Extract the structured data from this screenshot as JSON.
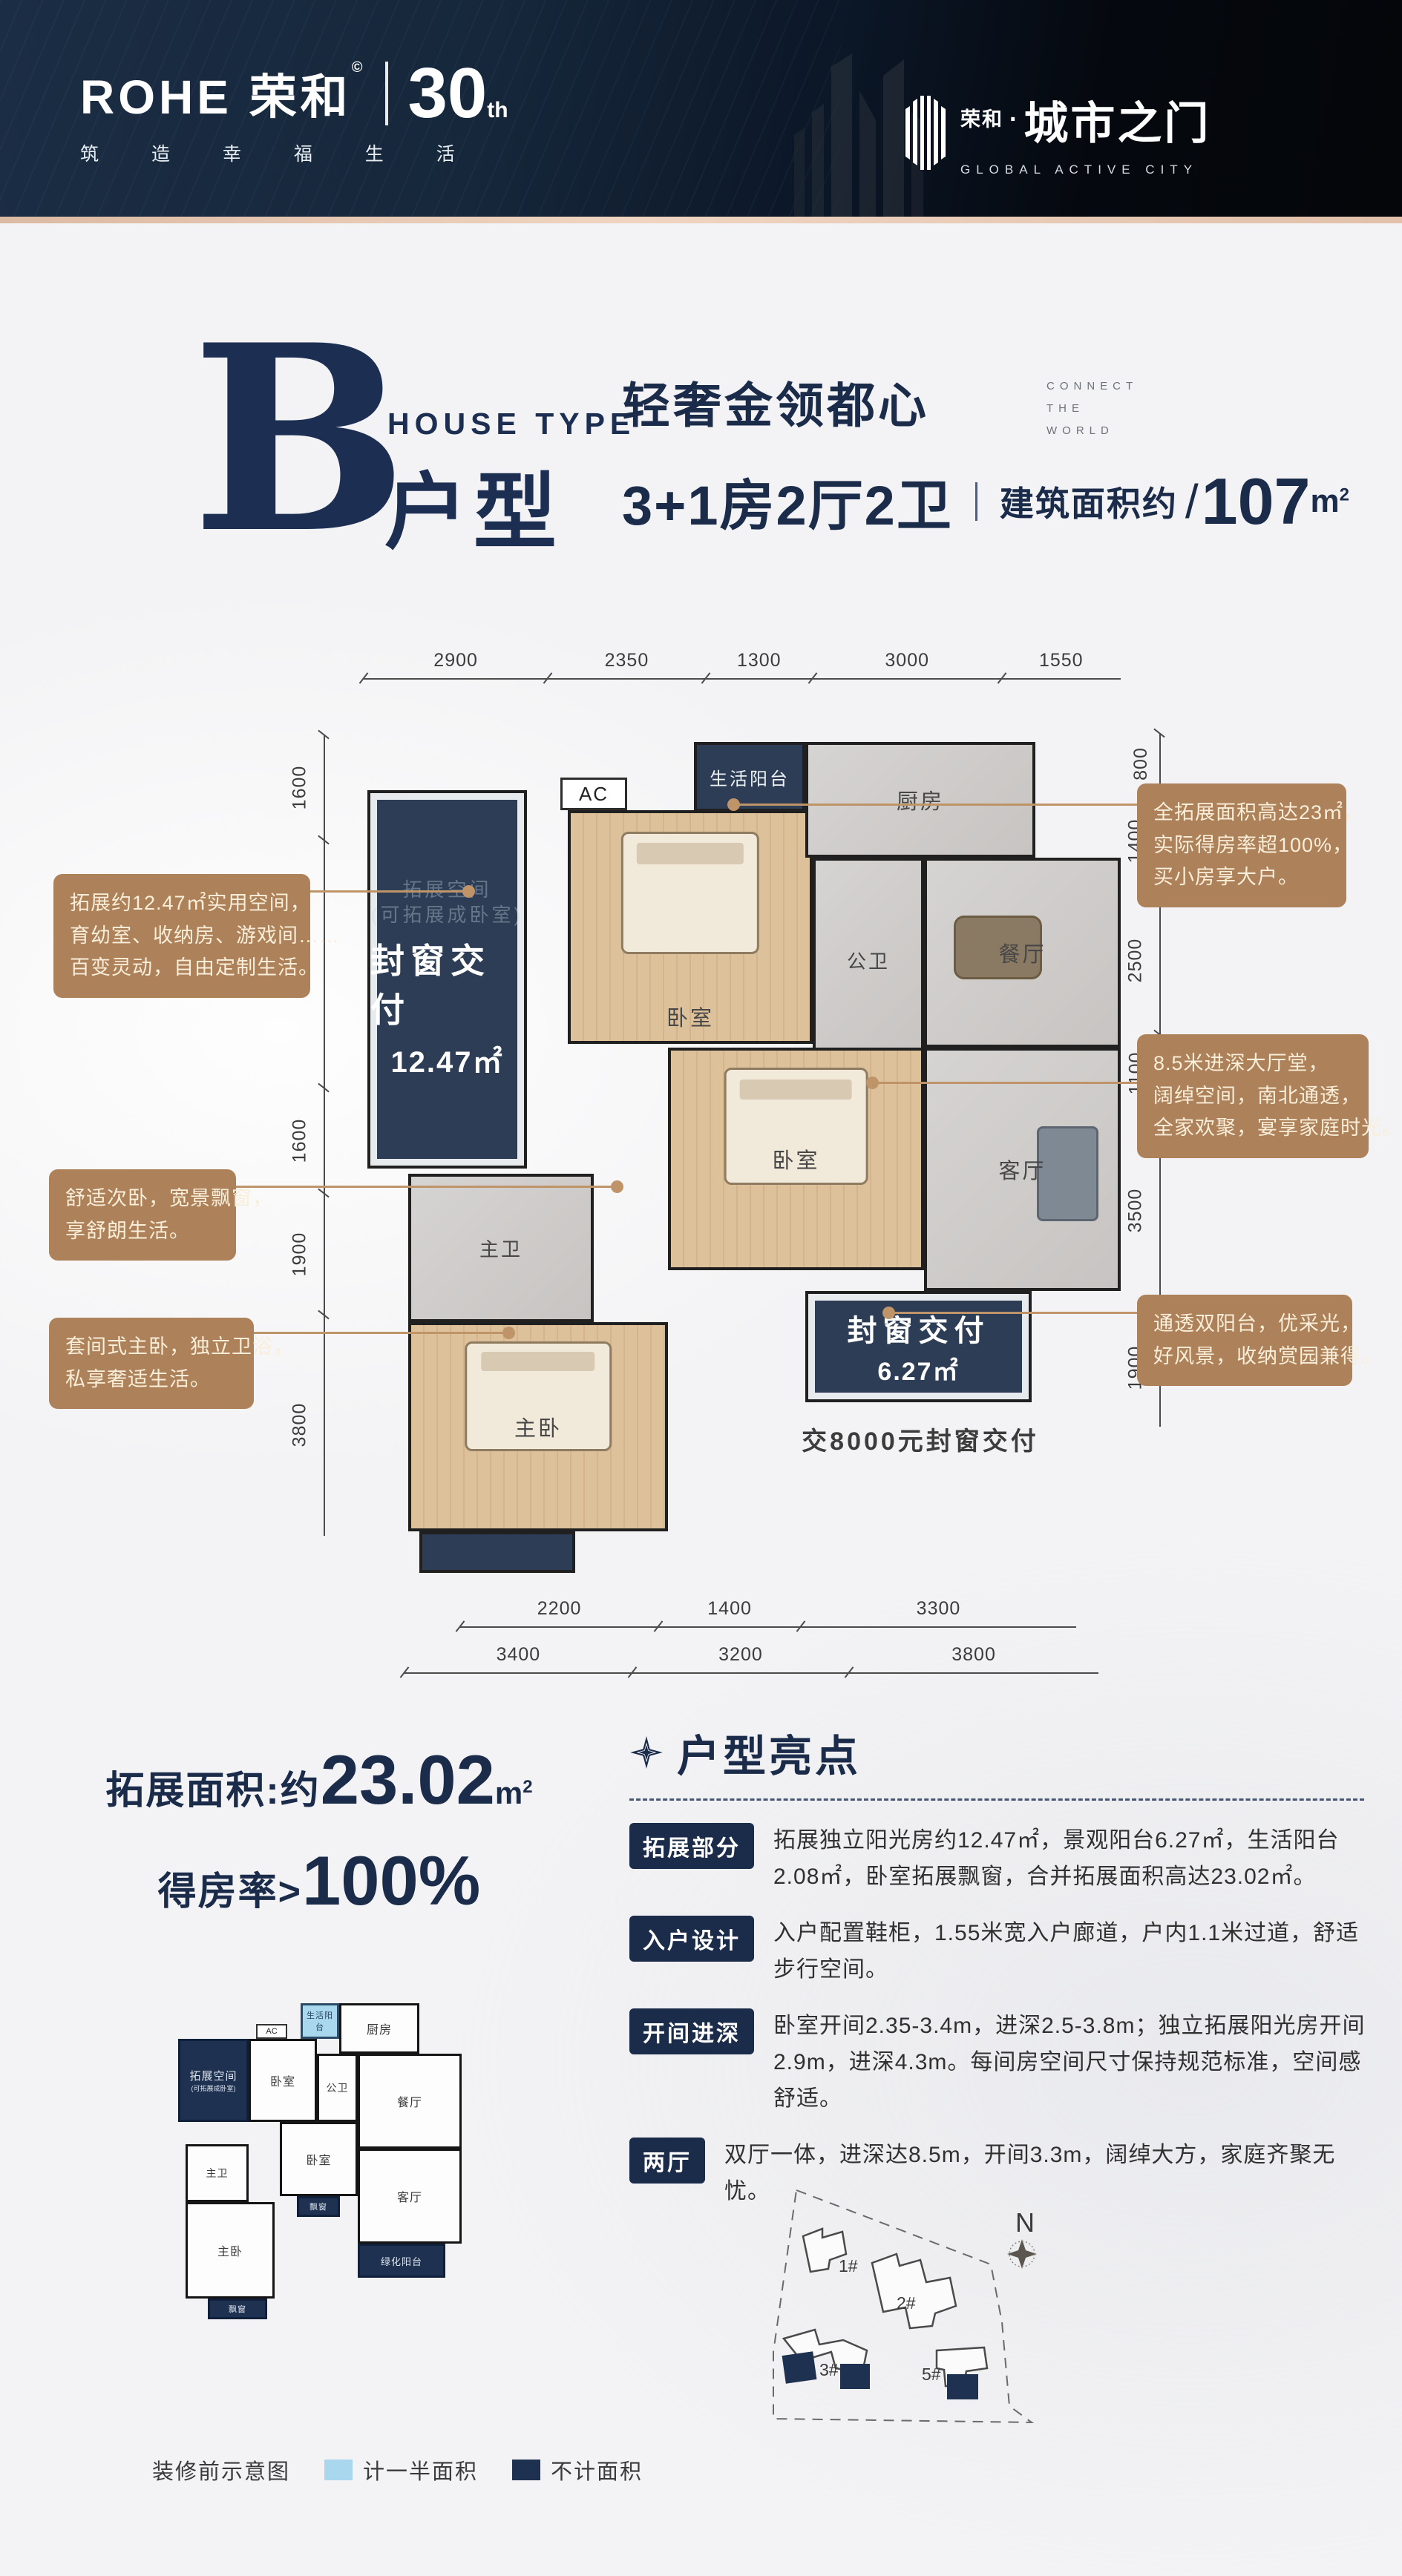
{
  "header": {
    "rohe": "ROHE 荣和",
    "reg": "©",
    "slogan": "筑 造 幸 福 生 活",
    "thirty": "30",
    "th": "th",
    "proj_small": "荣和",
    "proj_dot": "·",
    "proj_big": "城市之门",
    "proj_en": "GLOBAL ACTIVE CITY"
  },
  "title": {
    "letter": "B",
    "en": "HOUSE TYPE",
    "cn": "户型",
    "tagline": "轻奢金领都心",
    "connect": [
      "CONNECT",
      "THE",
      "WORLD"
    ],
    "rooms": "3+1房2厅2卫",
    "area_label": "建筑面积约",
    "slash": "/",
    "area_value": "107",
    "area_unit": "m",
    "area_sup": "2"
  },
  "plan": {
    "dims_top": [
      2900,
      2350,
      1300,
      3000,
      1550
    ],
    "dims_left": [
      1600,
      4300,
      1600,
      1900,
      3800
    ],
    "dims_right": [
      800,
      1400,
      2500,
      1100,
      3500,
      1900
    ],
    "dims_bottom_inner": [
      2200,
      1400,
      3300
    ],
    "dims_bottom_outer": [
      3400,
      3200,
      3800
    ],
    "ac": "AC",
    "rooms": {
      "svc_balcony": "生活阳台",
      "kitchen": "厨房",
      "dining": "餐厅",
      "living": "客厅",
      "guest_bath": "公卫",
      "bedroom1": "卧室",
      "bedroom2": "卧室",
      "master_bath": "主卫",
      "master_bed": "主卧"
    },
    "sealed1": {
      "title": "封窗交付",
      "ghost1": "拓展空间",
      "ghost2": "(可拓展成卧室)",
      "area": "12.47㎡"
    },
    "sealed2": {
      "title": "封窗交付",
      "ghost": "绿化阳台",
      "area": "6.27㎡"
    },
    "sealed_note": "交8000元封窗交付",
    "callout1": {
      "lines": [
        "拓展约12.47㎡实用空间，",
        "育幼室、收纳房、游戏间……",
        "百变灵动，自由定制生活。"
      ]
    },
    "callout2": {
      "lines": [
        "舒适次卧，宽景飘窗，",
        "享舒朗生活。"
      ]
    },
    "callout3": {
      "lines": [
        "套间式主卧，独立卫浴，",
        "私享奢适生活。"
      ]
    },
    "callout4": {
      "lines": [
        "全拓展面积高达23㎡，",
        "实际得房率超100%，",
        "买小房享大户。"
      ]
    },
    "callout5": {
      "lines": [
        "8.5米进深大厅堂，",
        "阔绰空间，南北通透，",
        "全家欢聚，宴享家庭时光。"
      ]
    },
    "callout6": {
      "lines": [
        "通透双阳台，优采光，",
        "好风景，收纳赏园兼得。"
      ]
    }
  },
  "stats": {
    "expand_label": "拓展面积:约",
    "expand_value": "23.02",
    "expand_unit": "m",
    "expand_sup": "2",
    "ratio_label": "得房率>",
    "ratio_value": "100%"
  },
  "highlights": {
    "title": "户型亮点",
    "items": [
      {
        "tag": "拓展部分",
        "text": "拓展独立阳光房约12.47㎡，景观阳台6.27㎡，生活阳台2.08㎡，卧室拓展飘窗，合并拓展面积高达23.02㎡。"
      },
      {
        "tag": "入户设计",
        "text": "入户配置鞋柜，1.55米宽入户廊道，户内1.1米过道，舒适步行空间。"
      },
      {
        "tag": "开间进深",
        "text": "卧室开间2.35-3.4m，进深2.5-3.8m；独立拓展阳光房开间2.9m，进深4.3m。每间房空间尺寸保持规范标准，空间感舒适。"
      },
      {
        "tag": "两厅",
        "text": "双厅一体，进深达8.5m，开间3.3m，阔绰大方，家庭齐聚无忧。"
      }
    ]
  },
  "miniplan": {
    "rooms": {
      "expand": "拓展空间",
      "expand_sub": "(可拓展成卧室)",
      "ac": "AC",
      "bedroom1": "卧室",
      "guest_bath": "公卫",
      "svc_balcony": "生活阳台",
      "kitchen": "厨房",
      "dining": "餐厅",
      "living": "客厅",
      "master_bath": "主卫",
      "bedroom2": "卧室",
      "master_bed": "主卧",
      "bay1": "飘窗",
      "bay2": "飘窗",
      "green_balcony": "绿化阳台"
    },
    "caption": "装修前示意图",
    "legend_half": "计一半面积",
    "legend_none": "不计面积"
  },
  "siteplan": {
    "north": "N",
    "b1": "1#",
    "b2": "2#",
    "b3": "3#",
    "b5": "5#"
  },
  "colors": {
    "navy": "#1b2b4a",
    "plan_navy": "#2c3d55",
    "callout_tan": "#ad8159",
    "wood": "#dcc09a",
    "tile": "#cfccc9",
    "light_blue": "#a9d7ee",
    "header_strip": "#e7c7b0"
  }
}
